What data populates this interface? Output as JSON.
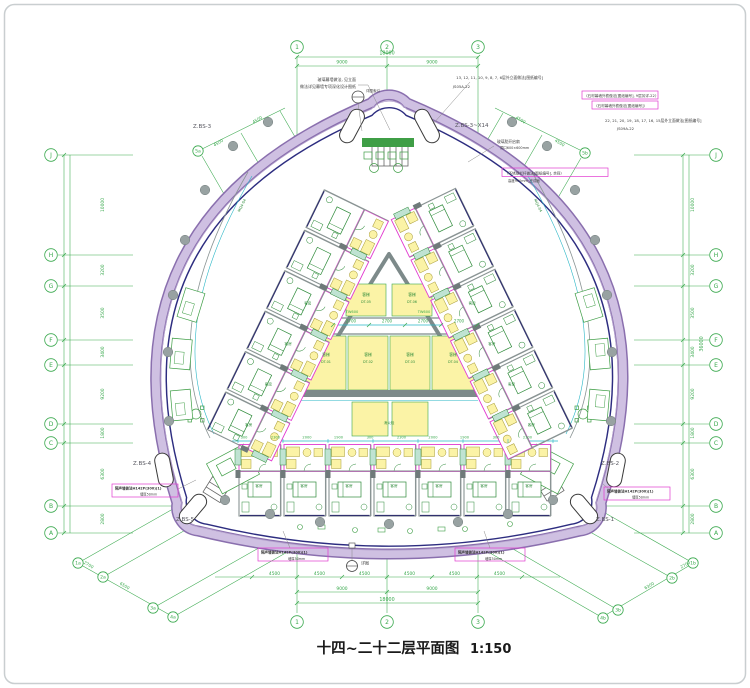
{
  "title": {
    "text": "十四~二十二层平面图",
    "scale": "1:150"
  },
  "grid": {
    "cols": [
      "1",
      "2",
      "3"
    ],
    "rows": [
      "J",
      "H",
      "G",
      "F",
      "E",
      "D",
      "C",
      "B",
      "A"
    ],
    "diag_ll": [
      "1a",
      "2a",
      "3a",
      "4a"
    ],
    "diag_lr": [
      "1b",
      "2b",
      "3b",
      "4b"
    ],
    "diag_ul": "5a",
    "diag_ur": "5b"
  },
  "dims": {
    "top": [
      "9000",
      "9000"
    ],
    "top_total": "18000",
    "bottom_units": [
      "4500",
      "4500",
      "4500",
      "4500",
      "4500",
      "4500"
    ],
    "bottom": [
      "9000",
      "9000"
    ],
    "bottom_total": "18000",
    "left": [
      "10000",
      "3200",
      "3500",
      "3400",
      "9200",
      "1800",
      "6300",
      "2800"
    ],
    "right_total": "36000",
    "diag_ll": [
      "2700",
      "6500"
    ],
    "diag_lr": [
      "2700",
      "6300"
    ],
    "diag_ul": [
      "4500",
      "4500"
    ],
    "diag_ur": [
      "4500",
      "4500"
    ],
    "core": [
      "2700",
      "2700",
      "2700",
      "2700"
    ],
    "room_row": [
      "300",
      "2300",
      "2000",
      "1900",
      "300",
      "2300",
      "2000",
      "1900",
      "300",
      "2300"
    ]
  },
  "labels": {
    "stair_tl": "Z.BS-3",
    "stair_tr": "Z.BS-3~X14",
    "stair_l": "Z.BS-4",
    "stair_r": "Z.BS-2",
    "stair_bl": "Z.BS-5",
    "stair_br": "Z.BS-1",
    "guest_room": "客房",
    "elevator": "客梯",
    "hydrant": "消火栓",
    "core_wall": "TW600",
    "mullion": "MQ4-04"
  },
  "core": {
    "ids": [
      "DT-01",
      "DT-02",
      "DT-03",
      "DT-04",
      "DT-05",
      "DT-06"
    ]
  },
  "annotations": {
    "tl1": "玻璃幕墙做法, 见立面",
    "tl2": "做法详见幕墙专项深化设计图纸",
    "tc": "详图索引",
    "tr1": "13, 12, 11, 10, 9, 8, 7, 6层外立面做法[图纸编号]",
    "tr1b": "JS05A-22",
    "tr2": "〈石材幕墙外檐做法[图纸编号], 9层另详-22〉",
    "tr3": "〈石材幕墙外檐做法[图纸编号]〉",
    "tr4": "22, 21, 20, 19, 18, 17, 16, 15层外立面做法[图纸编号]",
    "tr4b": "JS09A-22",
    "r1": "〈不锈钢栏杆做法[图纸编号], 余同〉",
    "r1b": "高度900mm_完成面",
    "r2a": "玻璃肋开启扇",
    "r2b": "洞口600×600mm",
    "ml1": "隔声墙做法H142P(300)(1)",
    "ml2": "墙厚50mm",
    "mr1": "隔声墙做法H142P(300)(1)",
    "mr2": "墙厚50mm",
    "bl1": "隔声墙做法H142P(300)(1)",
    "bl2": "墙厚50mm",
    "br1": "隔声墙做法H142P(300)(1)",
    "br2": "墙厚50mm",
    "bc": "详图"
  },
  "colors": {
    "grid_green": "#3aa94e",
    "dim_cyan": "#29b6c6",
    "room_magenta": "#e23ad0",
    "room_yellow": "#fbf3a6",
    "band_purple": "#cfc0e2",
    "band_edge": "#8a6fae",
    "inner_navy": "#2d2d80",
    "wall_gray": "#7d8a8a"
  }
}
